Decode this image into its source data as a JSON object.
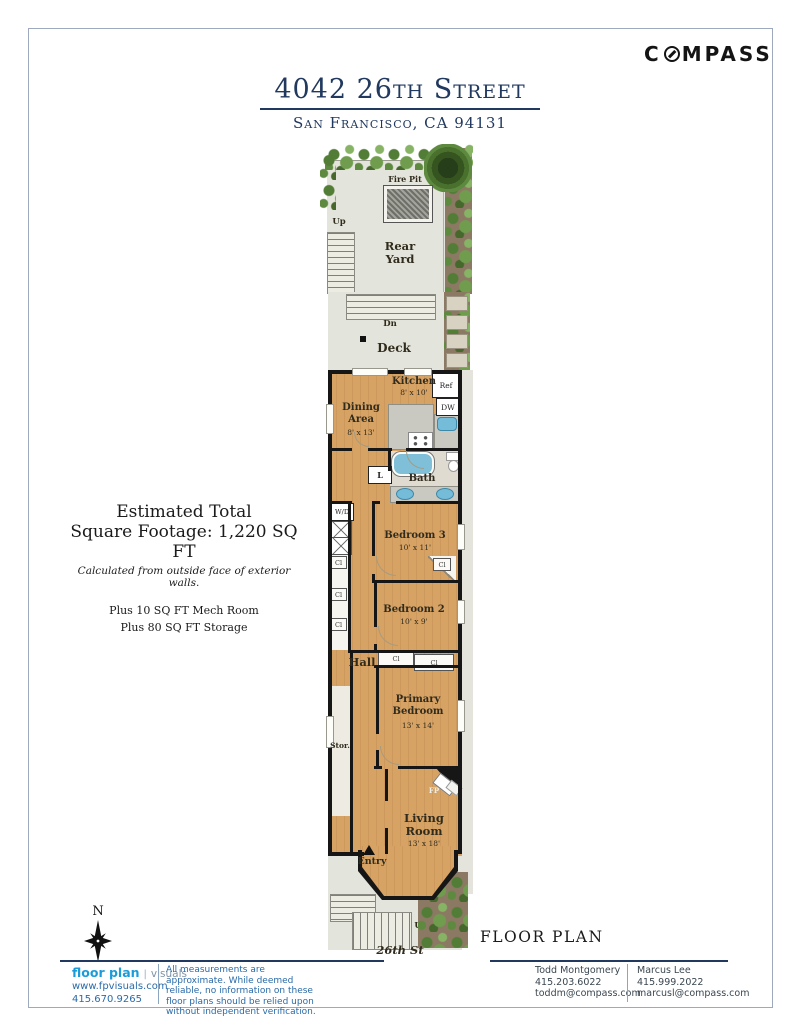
{
  "header": {
    "brand_left": "C",
    "brand_right": "MPASS",
    "title": "4042 26th Street",
    "subtitle": "San Francisco, CA 94131"
  },
  "estimate": {
    "line1": "Estimated Total",
    "line2": "Square Footage: 1,220 SQ FT",
    "note": "Calculated from outside face of exterior walls.",
    "plus1": "Plus 10 SQ FT Mech Room",
    "plus2": "Plus 80 SQ FT Storage"
  },
  "plan": {
    "labels": {
      "fire_pit": "Fire Pit",
      "rear_yard": "Rear Yard",
      "up": "Up",
      "down": "Dn",
      "deck": "Deck",
      "kitchen": "Kitchen",
      "kitchen_dim": "8' x 10'",
      "ref": "Ref",
      "dw": "DW",
      "dining": "Dining Area",
      "dining_dim": "8' x 13'",
      "linen": "L",
      "bath": "Bath",
      "wd": "W/D",
      "bedroom3": "Bedroom 3",
      "bedroom3_dim": "10' x 11'",
      "closet": "Cl",
      "bedroom2": "Bedroom 2",
      "bedroom2_dim": "10' x 9'",
      "hall": "Hall",
      "primary": "Primary Bedroom",
      "primary_dim": "13' x 14'",
      "stor": "Stor.",
      "fireplace": "FP",
      "living": "Living Room",
      "living_dim": "13' x 18'",
      "entry": "Entry",
      "street": "26th St"
    }
  },
  "caption": "FLOOR PLAN",
  "north": "N",
  "footer": {
    "logo_primary": "floor plan",
    "logo_secondary": "visuals",
    "website": "www.fpvisuals.com",
    "phone": "415.670.9265",
    "disclaimer": "All measurements are approximate. While deemed reliable, no information on these floor plans should be relied upon without independent verification.",
    "agents": [
      {
        "name": "Todd Montgomery",
        "phone": "415.203.6022",
        "email": "toddm@compass.com"
      },
      {
        "name": "Marcus Lee",
        "phone": "415.999.2022",
        "email": "marcusl@compass.com"
      }
    ]
  },
  "colors": {
    "navy": "#21395f",
    "logo_blue": "#1b9cd9",
    "footer_blue": "#2a6ba9",
    "wood": "#d7a365"
  }
}
